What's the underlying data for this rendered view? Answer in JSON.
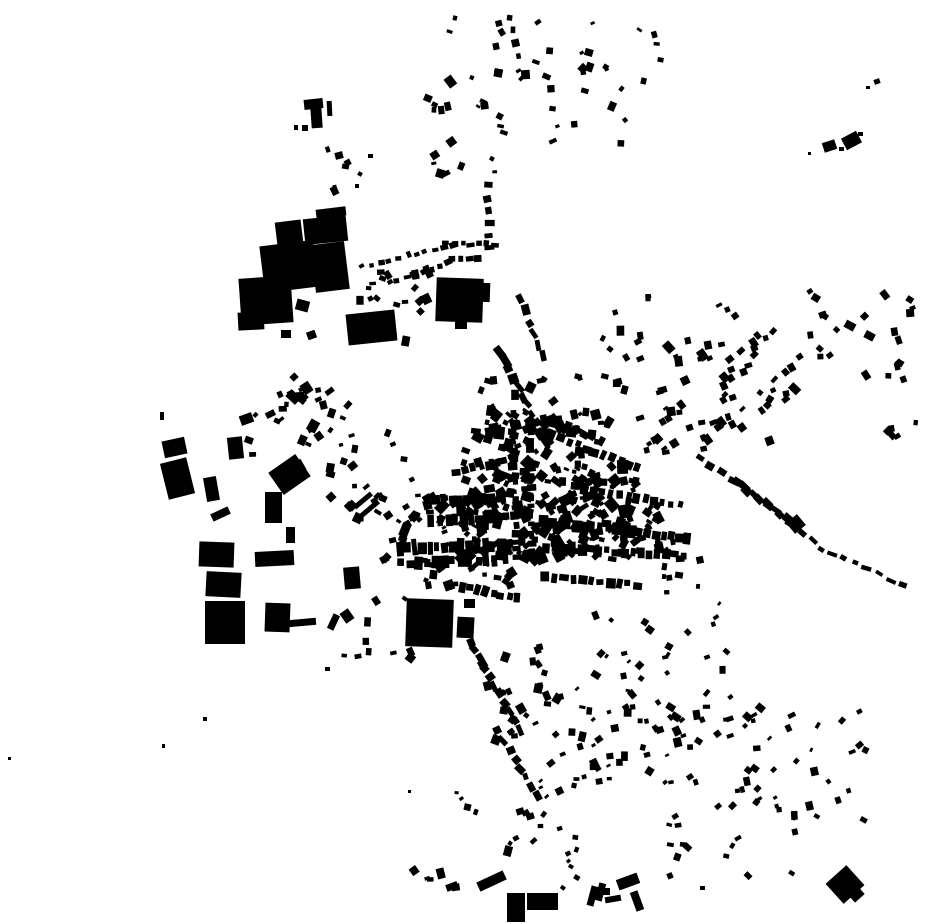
{
  "map": {
    "width": 930,
    "height": 924,
    "background": "#ffffff",
    "building_color": "#000000",
    "seed": 7,
    "block_fields": [
      "x",
      "y",
      "w",
      "h",
      "rot_deg"
    ],
    "blocks": [
      [
        276,
        221,
        26,
        23,
        -7
      ],
      [
        304,
        217,
        43,
        26,
        -6
      ],
      [
        262,
        243,
        54,
        47,
        -7
      ],
      [
        313,
        243,
        34,
        48,
        -7
      ],
      [
        240,
        277,
        52,
        47,
        -4
      ],
      [
        238,
        312,
        26,
        18,
        -3
      ],
      [
        316,
        208,
        30,
        9,
        -7
      ],
      [
        347,
        312,
        49,
        31,
        -6
      ],
      [
        296,
        300,
        13,
        11,
        15
      ],
      [
        281,
        330,
        10,
        8,
        0
      ],
      [
        307,
        331,
        9,
        8,
        -20
      ],
      [
        304,
        99,
        19,
        10,
        -6
      ],
      [
        311,
        107,
        11,
        21,
        -4
      ],
      [
        327,
        101,
        5,
        15,
        -3
      ],
      [
        302,
        125,
        6,
        6,
        0
      ],
      [
        294,
        125,
        4,
        5,
        0
      ],
      [
        335,
        152,
        8,
        7,
        -15
      ],
      [
        342,
        164,
        7,
        5,
        10
      ],
      [
        368,
        154,
        5,
        4,
        0
      ],
      [
        355,
        184,
        4,
        4,
        0
      ],
      [
        436,
        278,
        47,
        44,
        2
      ],
      [
        481,
        283,
        9,
        19,
        2
      ],
      [
        455,
        321,
        12,
        8,
        0
      ],
      [
        406,
        599,
        47,
        48,
        2
      ],
      [
        457,
        617,
        17,
        21,
        3
      ],
      [
        464,
        599,
        11,
        9,
        0
      ],
      [
        163,
        439,
        23,
        17,
        -12
      ],
      [
        164,
        460,
        27,
        37,
        -14
      ],
      [
        228,
        437,
        15,
        22,
        -6
      ],
      [
        240,
        414,
        13,
        10,
        -20
      ],
      [
        205,
        477,
        13,
        24,
        -10
      ],
      [
        199,
        542,
        35,
        25,
        2
      ],
      [
        206,
        572,
        35,
        25,
        3
      ],
      [
        205,
        601,
        40,
        43,
        0
      ],
      [
        265,
        603,
        25,
        29,
        2
      ],
      [
        255,
        551,
        39,
        15,
        -3
      ],
      [
        273,
        461,
        33,
        27,
        -35
      ],
      [
        265,
        492,
        17,
        31,
        0
      ],
      [
        211,
        510,
        19,
        8,
        -25
      ],
      [
        286,
        527,
        9,
        16,
        0
      ],
      [
        344,
        567,
        16,
        22,
        -5
      ],
      [
        352,
        498,
        22,
        5,
        -40
      ],
      [
        359,
        506,
        22,
        5,
        -40
      ],
      [
        288,
        619,
        28,
        7,
        -5
      ],
      [
        330,
        614,
        7,
        16,
        25
      ],
      [
        342,
        610,
        10,
        12,
        -35
      ],
      [
        325,
        667,
        5,
        4,
        0
      ],
      [
        203,
        717,
        4,
        4,
        0
      ],
      [
        160,
        412,
        4,
        8,
        0
      ],
      [
        8,
        757,
        3,
        3,
        0
      ],
      [
        162,
        744,
        3,
        4,
        0
      ],
      [
        408,
        790,
        3,
        3,
        0
      ],
      [
        823,
        141,
        13,
        10,
        -18
      ],
      [
        843,
        134,
        17,
        13,
        -28
      ],
      [
        839,
        147,
        5,
        4,
        0
      ],
      [
        858,
        132,
        5,
        4,
        0
      ],
      [
        808,
        152,
        3,
        3,
        0
      ],
      [
        874,
        79,
        6,
        5,
        -20
      ],
      [
        866,
        86,
        4,
        3,
        0
      ],
      [
        831,
        871,
        28,
        27,
        -42
      ],
      [
        849,
        887,
        13,
        13,
        -42
      ],
      [
        507,
        893,
        18,
        29,
        0
      ],
      [
        527,
        893,
        31,
        17,
        0
      ],
      [
        477,
        876,
        29,
        10,
        -25
      ],
      [
        446,
        883,
        12,
        7,
        -20
      ],
      [
        589,
        886,
        7,
        20,
        15
      ],
      [
        597,
        883,
        7,
        18,
        15
      ],
      [
        603,
        888,
        7,
        7,
        0
      ],
      [
        605,
        896,
        16,
        6,
        -10
      ],
      [
        617,
        876,
        22,
        11,
        -20
      ],
      [
        633,
        891,
        8,
        20,
        -20
      ],
      [
        700,
        886,
        5,
        4,
        0
      ],
      [
        789,
        517,
        14,
        14,
        -40
      ]
    ],
    "row_fields": [
      "x1",
      "y1",
      "x2",
      "y2",
      "count",
      "w",
      "h",
      "angle_jitter_deg"
    ],
    "rows": [
      [
        487,
        186,
        490,
        248,
        6,
        6,
        8,
        10
      ],
      [
        446,
        244,
        494,
        244,
        7,
        6,
        5,
        10
      ],
      [
        452,
        258,
        478,
        258,
        4,
        6,
        5,
        10
      ],
      [
        500,
        352,
        542,
        432,
        10,
        10,
        7,
        15
      ],
      [
        521,
        300,
        543,
        356,
        6,
        8,
        6,
        15
      ],
      [
        509,
        18,
        517,
        56,
        4,
        6,
        6,
        20
      ],
      [
        363,
        267,
        452,
        244,
        11,
        6,
        5,
        15
      ],
      [
        389,
        283,
        449,
        263,
        8,
        6,
        5,
        15
      ],
      [
        399,
        549,
        508,
        545,
        15,
        7,
        12,
        5
      ],
      [
        401,
        563,
        504,
        560,
        13,
        7,
        10,
        5
      ],
      [
        432,
        521,
        504,
        516,
        10,
        7,
        10,
        5
      ],
      [
        436,
        501,
        499,
        497,
        9,
        7,
        9,
        5
      ],
      [
        513,
        424,
        516,
        558,
        17,
        6,
        7,
        5
      ],
      [
        530,
        422,
        532,
        553,
        15,
        6,
        7,
        5
      ],
      [
        544,
        521,
        688,
        539,
        19,
        7,
        10,
        5
      ],
      [
        547,
        547,
        683,
        556,
        17,
        7,
        9,
        5
      ],
      [
        543,
        432,
        638,
        468,
        12,
        7,
        8,
        8
      ],
      [
        456,
        472,
        504,
        462,
        7,
        7,
        8,
        8
      ],
      [
        546,
        577,
        637,
        585,
        11,
        7,
        8,
        8
      ],
      [
        461,
        587,
        517,
        599,
        8,
        7,
        8,
        8
      ],
      [
        470,
        641,
        519,
        729,
        11,
        9,
        7,
        15
      ],
      [
        498,
        731,
        538,
        796,
        8,
        8,
        6,
        15
      ],
      [
        585,
        490,
        680,
        505,
        12,
        6,
        8,
        8
      ],
      [
        552,
        420,
        600,
        440,
        7,
        6,
        7,
        10
      ],
      [
        700,
        457,
        788,
        519,
        9,
        9,
        6,
        10
      ],
      [
        737,
        482,
        812,
        541,
        8,
        8,
        6,
        10
      ],
      [
        820,
        548,
        903,
        585,
        8,
        8,
        5,
        10
      ]
    ],
    "cluster_fields": [
      "cx",
      "cy",
      "rx",
      "ry",
      "count",
      "min_size",
      "max_size",
      "angle_deg",
      "angle_jitter_deg"
    ],
    "clusters": [
      [
        520,
        62,
        95,
        45,
        26,
        4,
        9,
        -10,
        40
      ],
      [
        470,
        140,
        65,
        40,
        16,
        4,
        9,
        0,
        40
      ],
      [
        590,
        105,
        45,
        40,
        10,
        4,
        8,
        0,
        40
      ],
      [
        640,
        55,
        25,
        35,
        6,
        4,
        7,
        0,
        40
      ],
      [
        350,
        170,
        28,
        22,
        5,
        4,
        7,
        0,
        40
      ],
      [
        390,
        305,
        40,
        38,
        22,
        5,
        9,
        -15,
        35
      ],
      [
        300,
        428,
        55,
        42,
        22,
        5,
        10,
        -10,
        40
      ],
      [
        295,
        390,
        40,
        25,
        10,
        4,
        8,
        -15,
        40
      ],
      [
        375,
        475,
        45,
        45,
        24,
        4,
        9,
        0,
        45
      ],
      [
        400,
        530,
        30,
        35,
        16,
        4,
        9,
        0,
        45
      ],
      [
        703,
        397,
        68,
        62,
        48,
        5,
        9,
        -25,
        20
      ],
      [
        772,
        362,
        60,
        58,
        26,
        5,
        8,
        -35,
        30
      ],
      [
        858,
        332,
        55,
        48,
        22,
        5,
        8,
        -30,
        35
      ],
      [
        905,
        392,
        18,
        48,
        7,
        4,
        7,
        -20,
        30
      ],
      [
        635,
        330,
        35,
        40,
        9,
        4,
        8,
        0,
        40
      ],
      [
        600,
        400,
        30,
        30,
        9,
        4,
        8,
        0,
        40
      ],
      [
        678,
        566,
        22,
        28,
        13,
        4,
        8,
        85,
        15
      ],
      [
        625,
        650,
        35,
        35,
        12,
        4,
        8,
        -35,
        25
      ],
      [
        600,
        742,
        62,
        55,
        40,
        4,
        8,
        -15,
        30
      ],
      [
        700,
        748,
        58,
        58,
        34,
        4,
        8,
        -30,
        30
      ],
      [
        800,
        762,
        68,
        58,
        30,
        4,
        8,
        -35,
        30
      ],
      [
        735,
        842,
        75,
        38,
        16,
        4,
        7,
        -20,
        40
      ],
      [
        522,
        700,
        42,
        55,
        24,
        5,
        9,
        0,
        40
      ],
      [
        498,
        828,
        48,
        42,
        14,
        4,
        8,
        -20,
        40
      ],
      [
        390,
        625,
        48,
        42,
        12,
        4,
        9,
        0,
        40
      ],
      [
        692,
        645,
        42,
        45,
        11,
        4,
        7,
        -20,
        40
      ],
      [
        432,
        877,
        26,
        11,
        6,
        4,
        8,
        -20,
        30
      ],
      [
        565,
        860,
        12,
        32,
        8,
        4,
        7,
        0,
        40
      ],
      [
        520,
        492,
        62,
        70,
        110,
        4,
        11,
        0,
        45
      ],
      [
        580,
        512,
        58,
        48,
        80,
        4,
        11,
        0,
        45
      ],
      [
        472,
        540,
        48,
        48,
        60,
        4,
        10,
        0,
        45
      ],
      [
        548,
        448,
        55,
        35,
        50,
        4,
        10,
        0,
        45
      ],
      [
        625,
        520,
        42,
        40,
        40,
        4,
        9,
        0,
        45
      ],
      [
        520,
        400,
        40,
        25,
        15,
        5,
        9,
        0,
        45
      ]
    ]
  }
}
